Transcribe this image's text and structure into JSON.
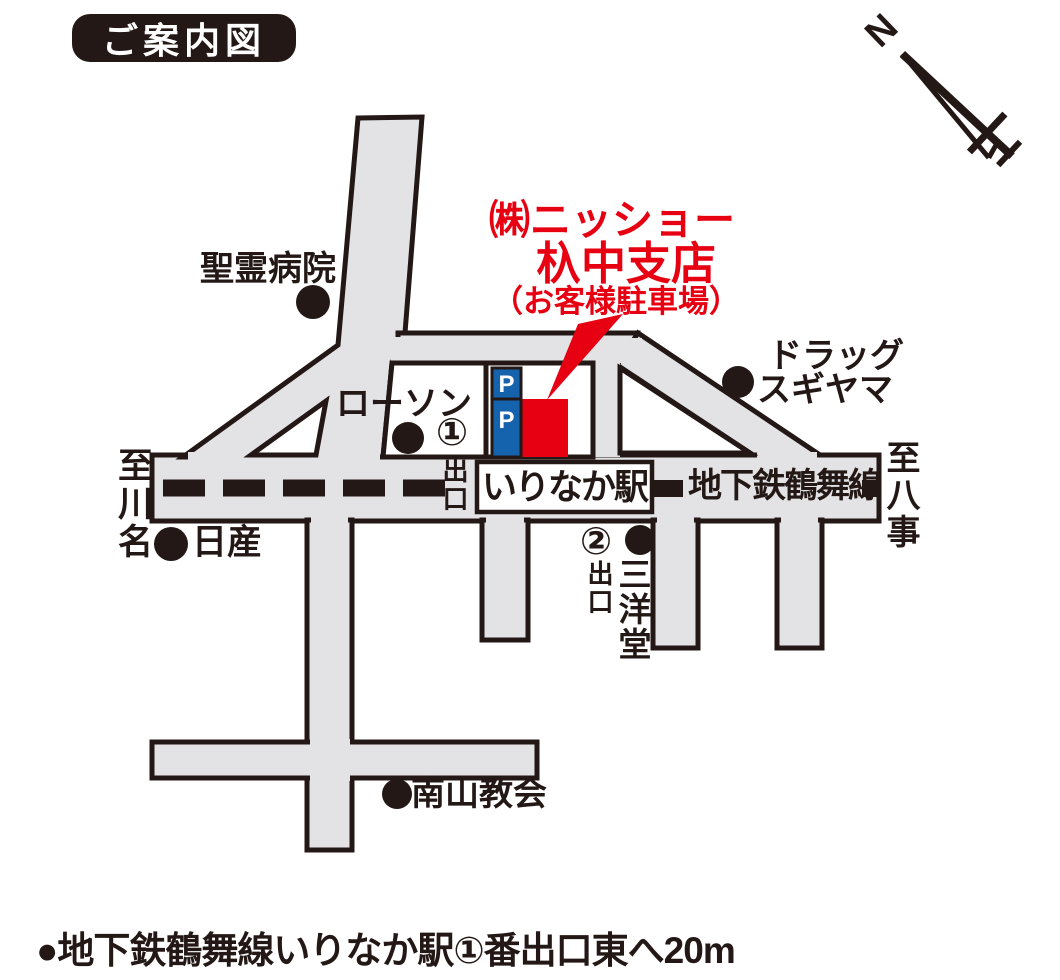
{
  "title": "ご案内図",
  "colors": {
    "ink": "#231815",
    "road": "#e3e3e5",
    "red": "#e60012",
    "blue": "#1463ac",
    "white": "#ffffff"
  },
  "compass": {
    "north": "N"
  },
  "destination": {
    "name_line1": "㈱ニッショー",
    "name_line2": "杁中支店",
    "note": "（お客様駐車場）"
  },
  "parking": {
    "sign_top": "P",
    "sign_bottom": "P"
  },
  "station": {
    "name": "いりなか駅",
    "line": "地下鉄鶴舞線"
  },
  "exits": {
    "exit1_number": "①",
    "exit1_label": "出口",
    "exit2_number": "②",
    "exit2_label": "出口"
  },
  "directions": {
    "west": "至川名",
    "east": "至八事"
  },
  "landmarks": {
    "hospital": "聖霊病院",
    "convenience_store": "ローソン",
    "drugstore_line1": "ドラッグ",
    "drugstore_line2": "スギヤマ",
    "car_dealer": "日産",
    "bookstore": "三洋堂",
    "church": "南山教会"
  },
  "footer": "●地下鉄鶴舞線いりなか駅①番出口東へ20m"
}
